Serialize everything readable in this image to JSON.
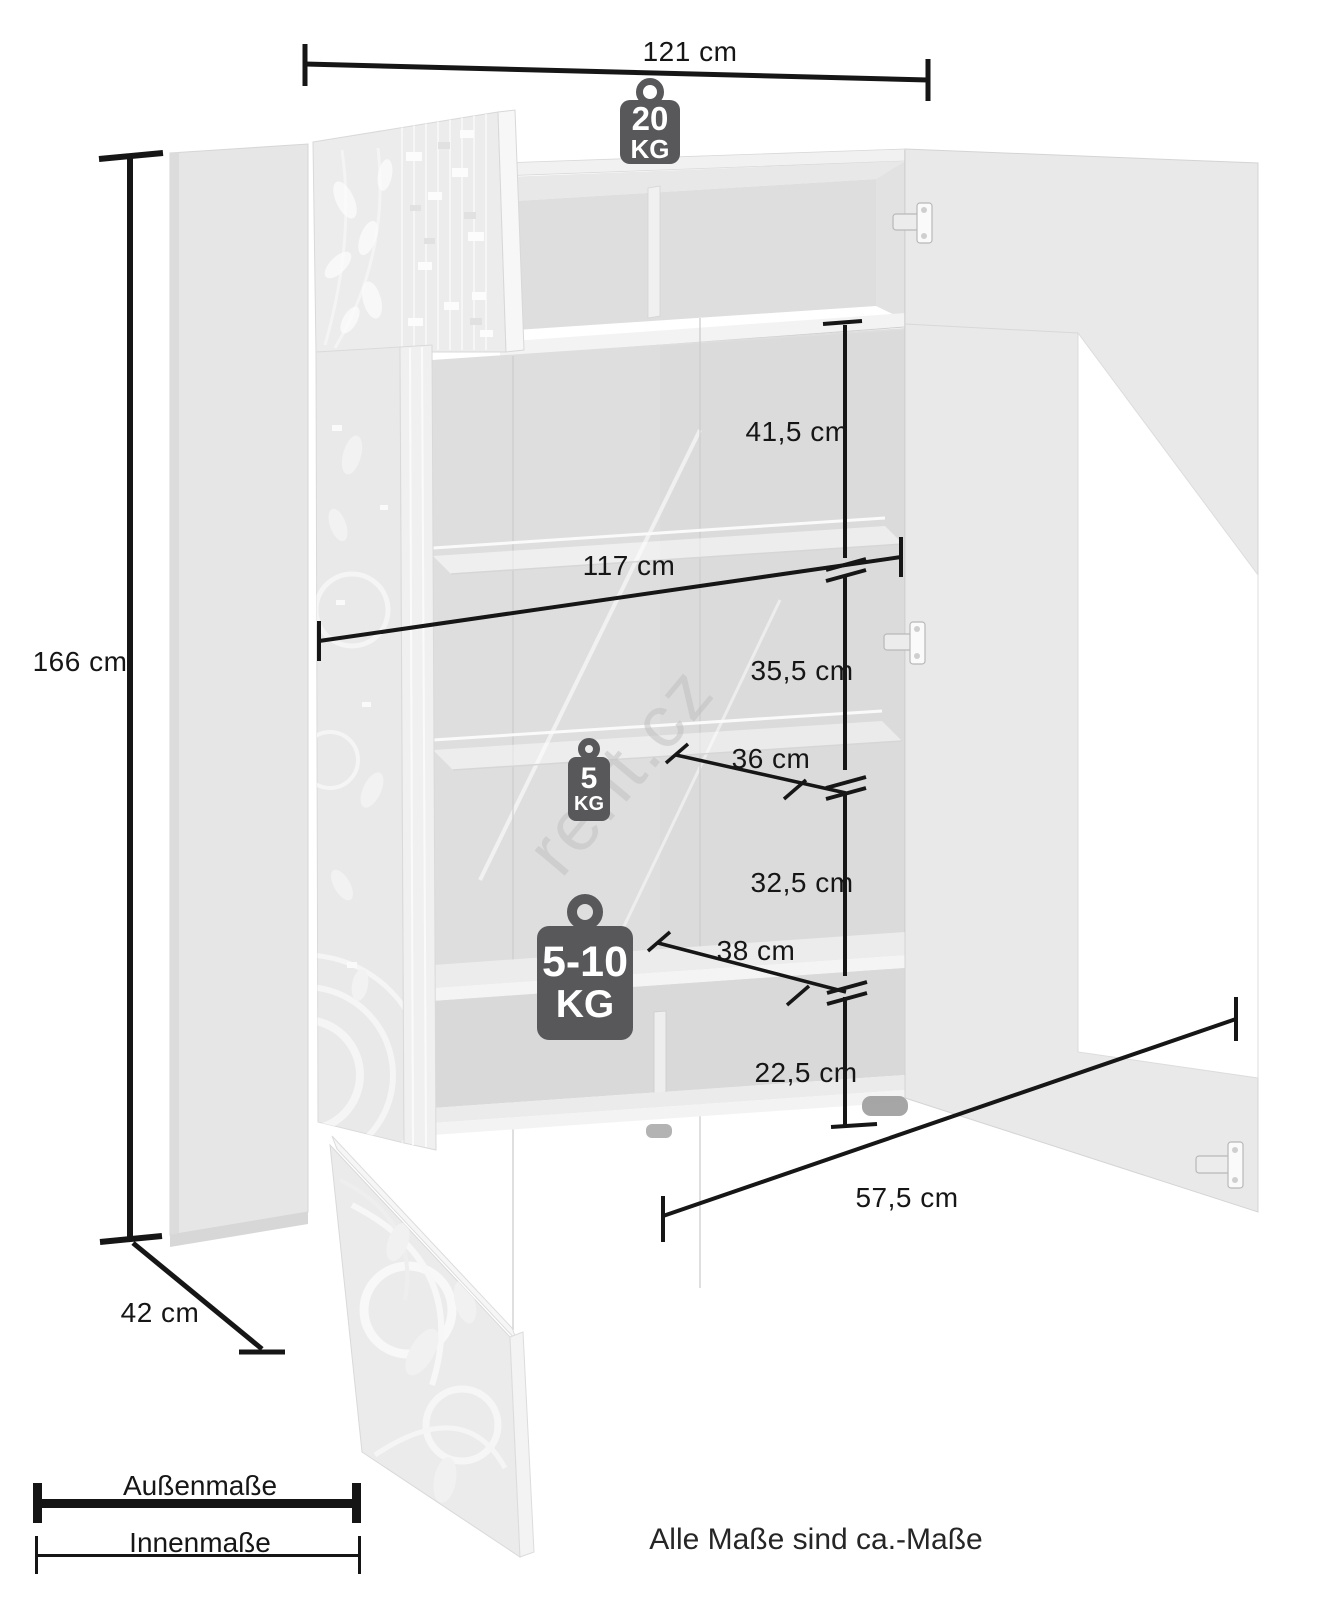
{
  "diagram": {
    "watermark": "rent.cz",
    "footer_note": "Alle Maße sind ca.-Maße",
    "dimensions": {
      "outer_width": "121 cm",
      "outer_height": "166 cm",
      "outer_depth": "42 cm",
      "inner_width": "117 cm",
      "top_shelf_height": "41,5 cm",
      "middle_shelf_height": "35,5 cm",
      "glass_shelf_depth": "36 cm",
      "lower_shelf_height": "32,5 cm",
      "lower_shelf_depth": "38 cm",
      "bottom_compartment_height": "22,5 cm",
      "bottom_compartment_width": "57,5 cm"
    },
    "load_badges": {
      "top": {
        "value": "20",
        "unit": "KG"
      },
      "glass_shelf": {
        "value": "5",
        "unit": "KG"
      },
      "lower_shelf": {
        "value": "5-10",
        "unit": "KG"
      }
    },
    "legend": {
      "outer": "Außenmaße",
      "inner": "Innenmaße"
    },
    "colors": {
      "dimension_line": "#161616",
      "badge": "#58585b",
      "cabinet_light": "#e9e9e9",
      "cabinet_shadow": "#d9d9d9",
      "watermark": "#bebebe"
    }
  }
}
